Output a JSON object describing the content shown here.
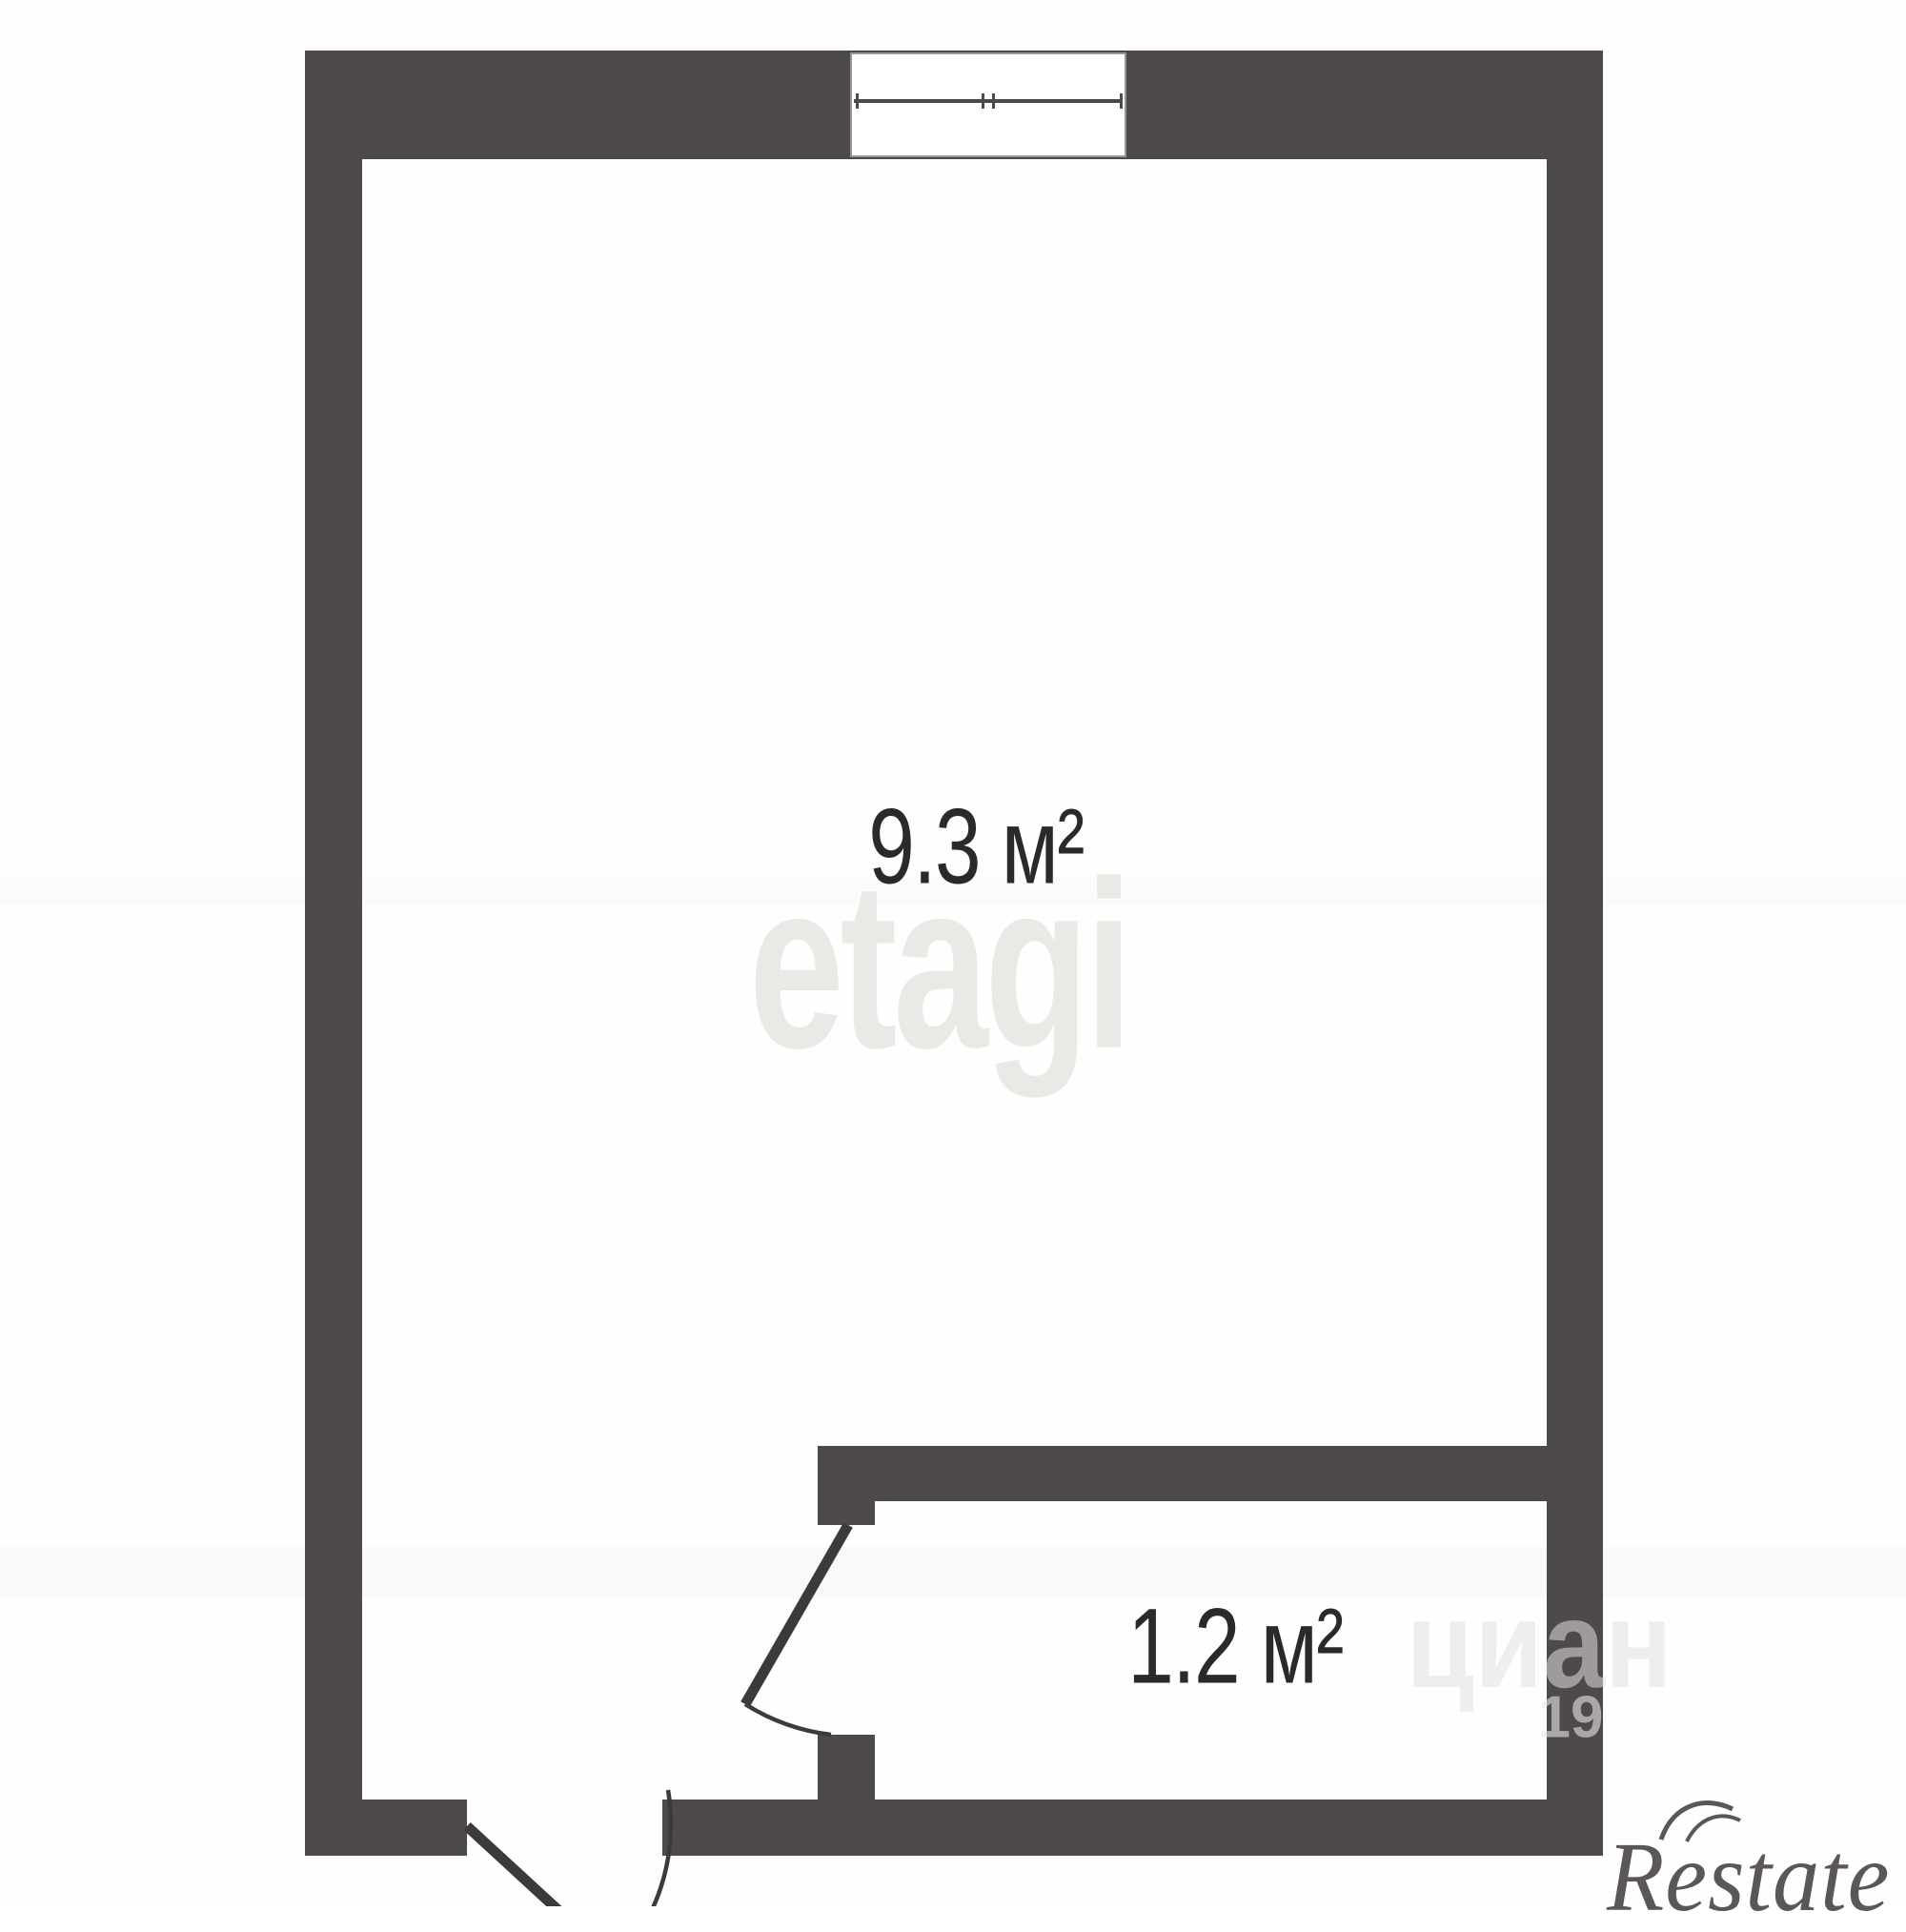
{
  "floorplan": {
    "wall_color": "#4e4a4a",
    "line_color": "#3d3a3a",
    "rooms": [
      {
        "id": "main-room",
        "area_label": "9.3 м²"
      },
      {
        "id": "hall-room",
        "area_label": "1.2 м²"
      }
    ],
    "watermarks": {
      "brand_text": "etagi",
      "brand_color": "#ebe9e5",
      "fragment_text": "циан",
      "fragment_number": "19",
      "logo_text": "Restate",
      "logo_color": "#5c5757"
    }
  }
}
